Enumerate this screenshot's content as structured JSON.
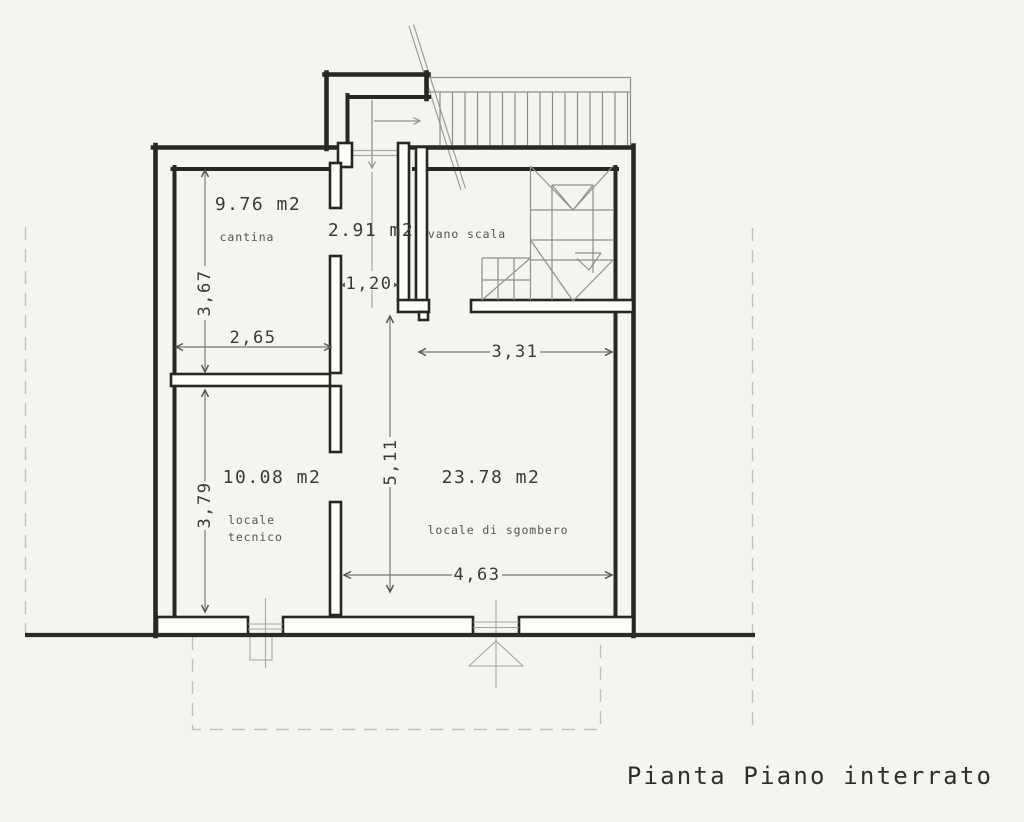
{
  "document": {
    "kind": "scanned architectural floor plan",
    "title": "Pianta Piano interrato"
  },
  "rooms": [
    {
      "id": "cantina",
      "area": "9.76 m2",
      "name": "cantina"
    },
    {
      "id": "disimpegno",
      "area": "2.91 m2",
      "name": ""
    },
    {
      "id": "vano-scala",
      "area": "",
      "name": "vano scala"
    },
    {
      "id": "locale-tecnico",
      "area": "10.08 m2",
      "name_line1": "locale",
      "name_line2": "tecnico"
    },
    {
      "id": "locale-di-sgombero",
      "area": "23.78 m2",
      "name": "locale di sgombero"
    }
  ],
  "dimensions": [
    {
      "id": "cantina-height",
      "value": "3,67",
      "orientation": "vertical"
    },
    {
      "id": "cantina-width",
      "value": "2,65",
      "orientation": "horizontal"
    },
    {
      "id": "corridor-door-width",
      "value": "1,20",
      "orientation": "horizontal"
    },
    {
      "id": "sgombero-top-width",
      "value": "3,31",
      "orientation": "horizontal"
    },
    {
      "id": "sgombero-height",
      "value": "5,11",
      "orientation": "vertical"
    },
    {
      "id": "tecnico-height",
      "value": "3,79",
      "orientation": "vertical"
    },
    {
      "id": "sgombero-width",
      "value": "4,63",
      "orientation": "horizontal"
    }
  ],
  "colors": {
    "paper": "#f5f4f0",
    "wall": "#272725",
    "thin_line": "#90908a",
    "axis_line": "#a8a8a2",
    "dashed_line": "#c0c0ba",
    "text": "#3b3b33"
  }
}
